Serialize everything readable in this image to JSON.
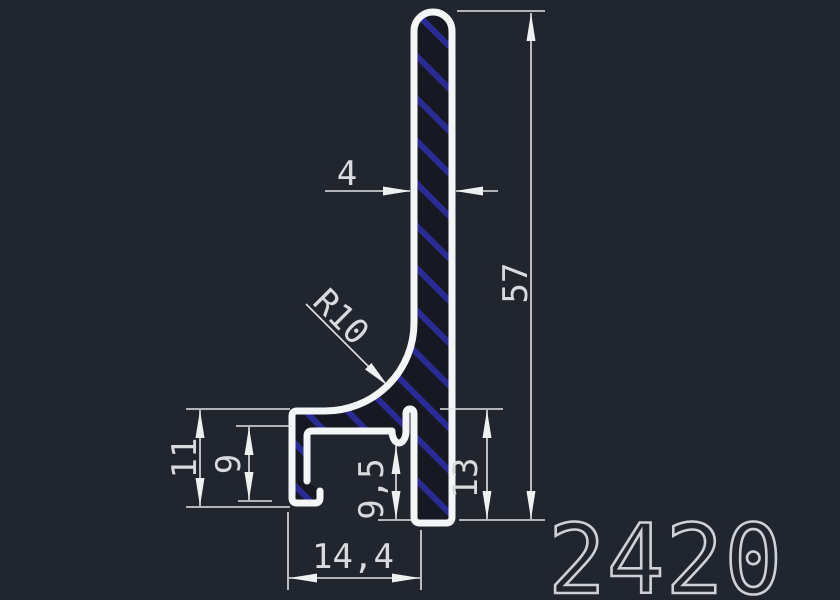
{
  "drawing": {
    "part_number": "2420",
    "dimensions": {
      "thickness": "4",
      "height": "57",
      "radius": "R10",
      "arm_outer_height": "11",
      "arm_inner_height": "9",
      "slot_depth": "9,5",
      "step_height": "13",
      "base_width": "14,4"
    },
    "colors": {
      "background": "#21252d",
      "outline": "#f4f5f6",
      "hatch": "#2b2b96",
      "dimension": "#d9dadd"
    }
  }
}
